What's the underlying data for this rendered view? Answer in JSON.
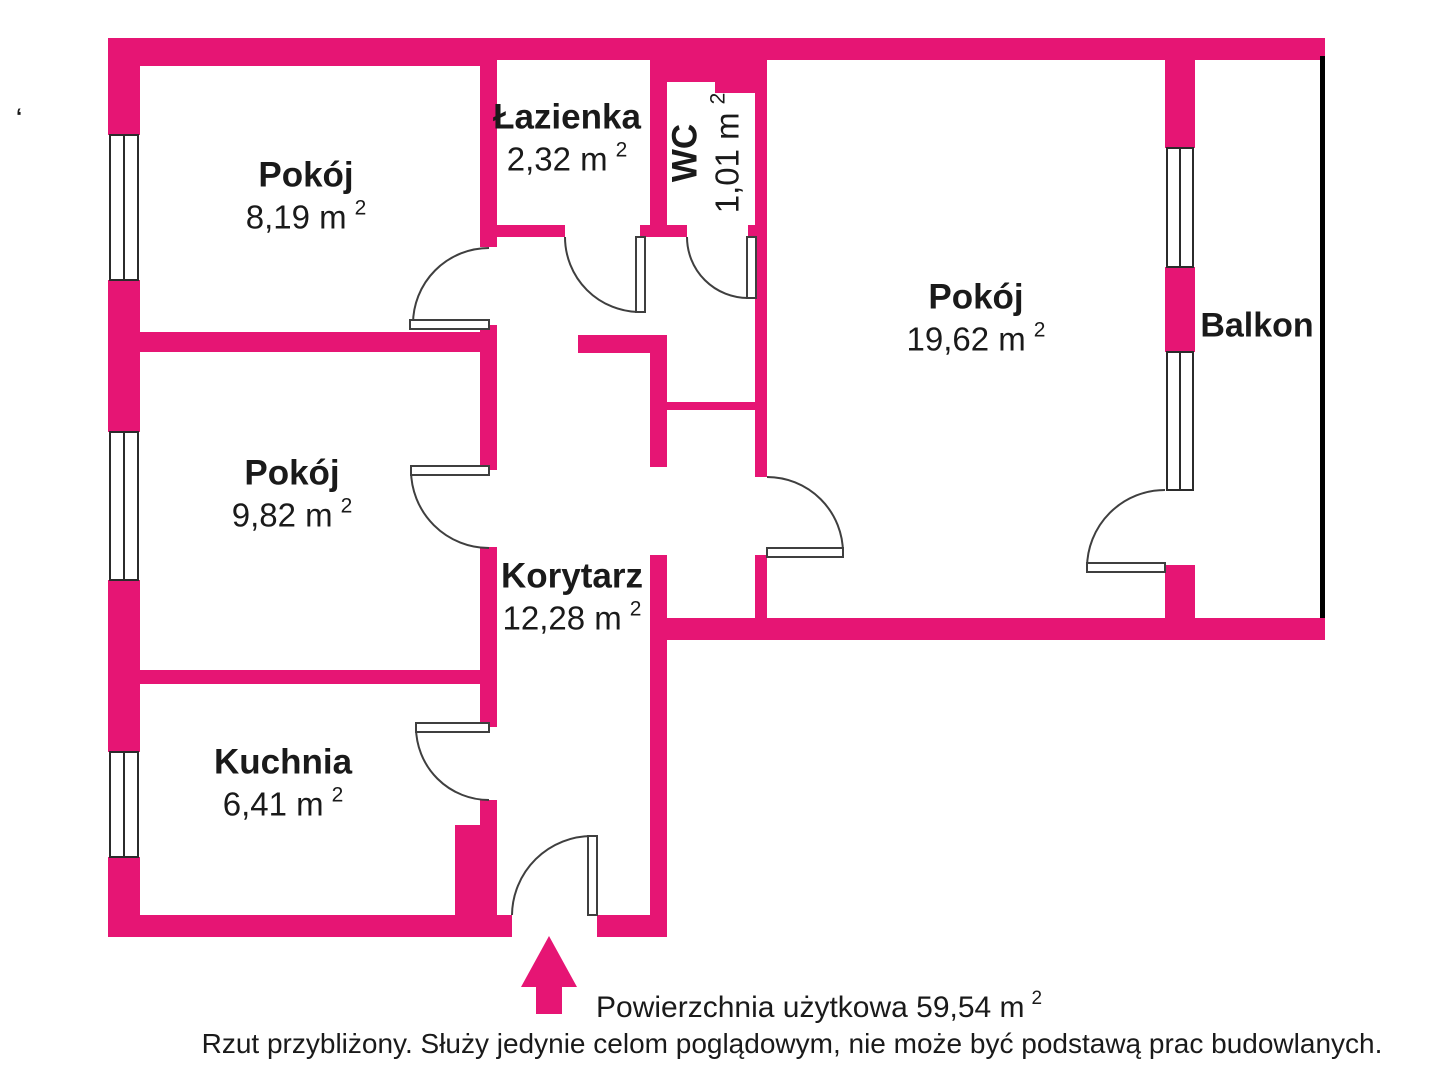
{
  "colors": {
    "wall": "#e61574",
    "door_line": "#3f3f3f",
    "window_line": "#2b2b2b",
    "balcony_line": "#000000"
  },
  "rooms": [
    {
      "name": "Pokój",
      "area": "8,19 m",
      "sup": "2"
    },
    {
      "name": "Łazienka",
      "area": "2,32 m",
      "sup": "2"
    },
    {
      "name": "WC",
      "area": "1,01 m",
      "sup": "2"
    },
    {
      "name": "Pokój",
      "area": "19,62 m",
      "sup": "2"
    },
    {
      "name": "Pokój",
      "area": "9,82 m",
      "sup": "2"
    },
    {
      "name": "Korytarz",
      "area": "12,28 m",
      "sup": "2"
    },
    {
      "name": "Kuchnia",
      "area": "6,41 m",
      "sup": "2"
    }
  ],
  "balcony_label": "Balkon",
  "stray_mark": "‘",
  "footer": {
    "area_label": "Powierzchnia użytkowa 59,54 m",
    "area_sup": "2",
    "disclaimer": "Rzut przybliżony. Służy jedynie celom poglądowym, nie może być podstawą prac budowlanych."
  }
}
